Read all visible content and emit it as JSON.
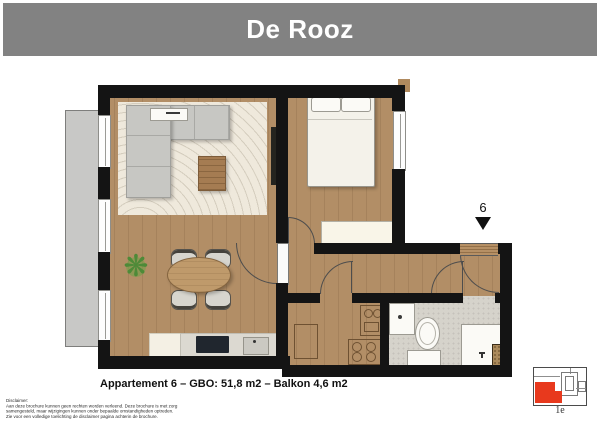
{
  "header": {
    "title": "De Rooz"
  },
  "plan": {
    "caption": "Appartement 6 – GBO: 51,8 m2 – Balkon 4,6 m2",
    "marker": {
      "number": "6"
    }
  },
  "minimap": {
    "floor_label": "1e"
  },
  "disclaimer": {
    "heading": "Disclaimer:",
    "lines": [
      "Aan deze brochure kunnen geen rechten worden verleend. Deze brochure is met zorg",
      "samengesteld, maar wijzigingen kunnen onder bepaalde omstandigheden optreden.",
      "Zie voor een volledige toelichting de disclaimer pagina achterin de brochure."
    ]
  },
  "colors": {
    "header_bg": "#828282",
    "wall": "#141414",
    "wood_floor": "#b28e66",
    "tile_floor": "#d6d3cb",
    "balcony": "#c8c8c6",
    "rug": "#efe9dc",
    "highlight_red": "#e8391d"
  }
}
